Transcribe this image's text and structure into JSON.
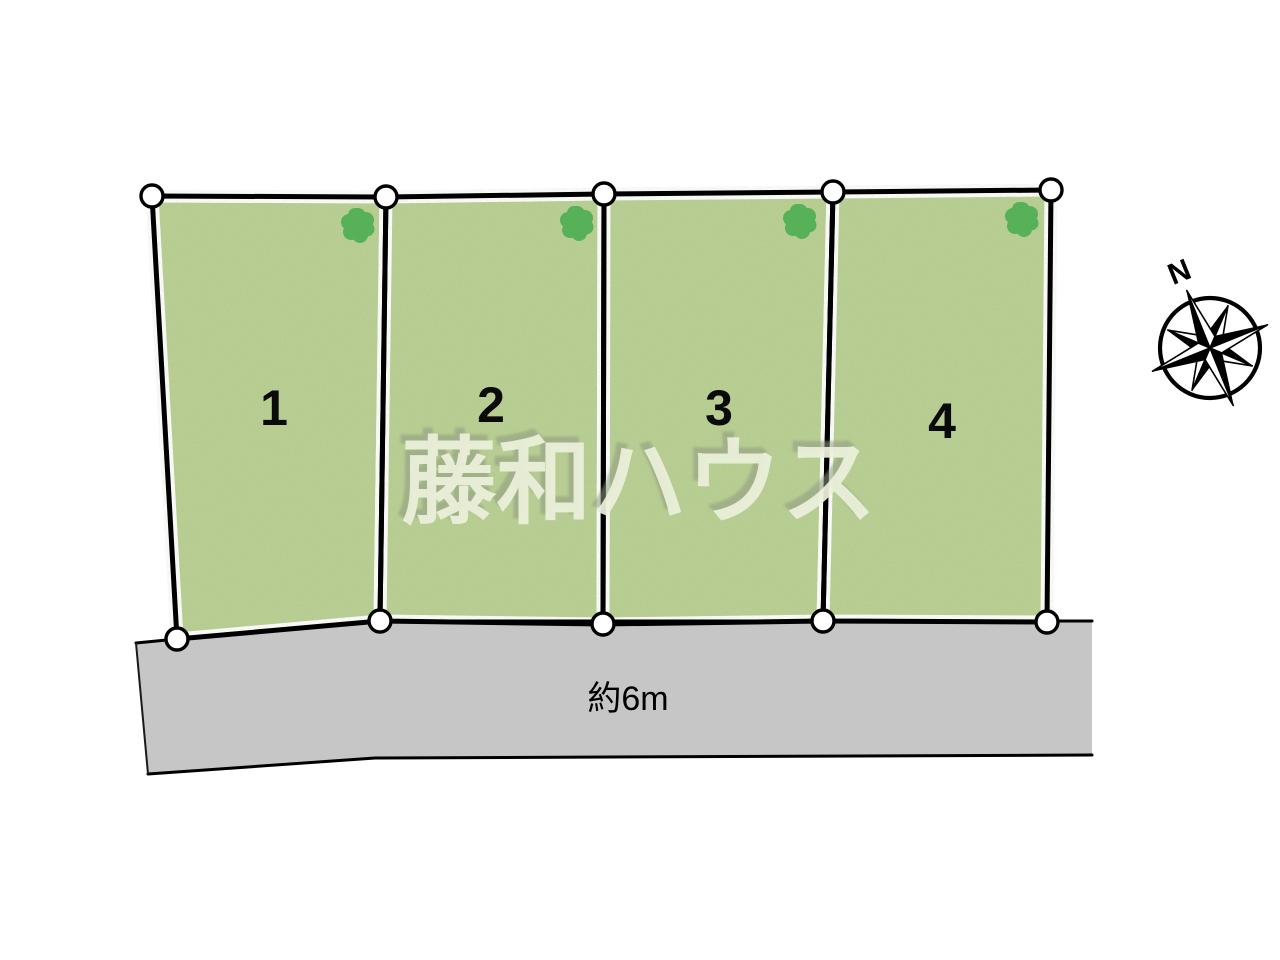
{
  "diagram": {
    "type": "real-estate-lot-site-plan",
    "lots": [
      {
        "number": "1"
      },
      {
        "number": "2"
      },
      {
        "number": "3"
      },
      {
        "number": "4"
      }
    ],
    "road": {
      "width_label": "約6m"
    },
    "compass": {
      "north_label": "N"
    },
    "watermark": {
      "text": "藤和ハウス"
    }
  },
  "icons": {
    "tree": "tree-canopy-blob",
    "compass": "eight-point-compass-rose",
    "survey_point": "white-circle-marker"
  },
  "colors": {
    "lot_green": "#b9cf93",
    "tree_green": "#56b158",
    "road_gray": "#c6c6c7",
    "outline_black": "#000000",
    "watermark_fill": "#edf1dc",
    "watermark_shadow": "#8e9a80"
  }
}
